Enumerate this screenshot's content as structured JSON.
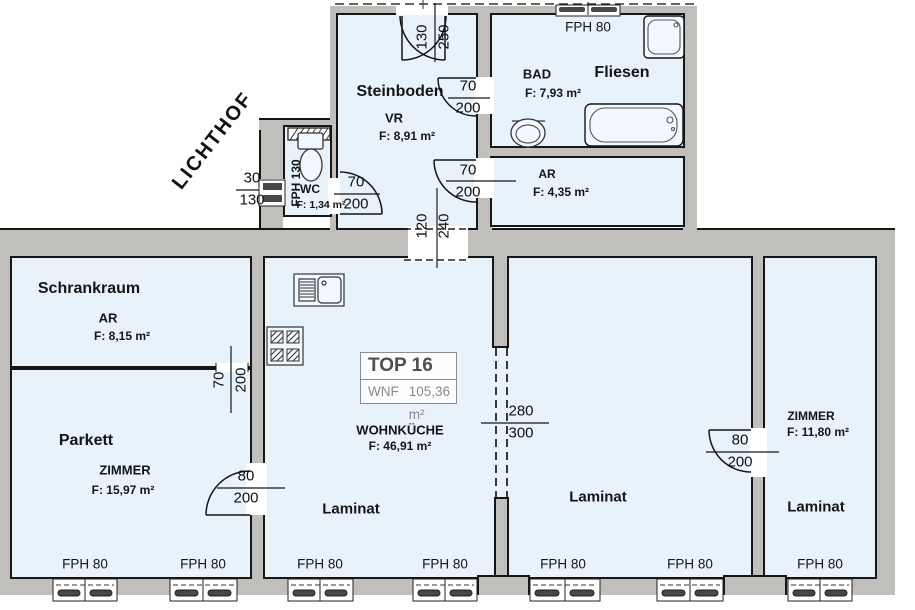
{
  "unit_box": {
    "title": "TOP 16",
    "wnf_label": "WNF",
    "wnf_value": "105,36 m²"
  },
  "labels": {
    "lichthof": "LICHTHOF",
    "steinboden": "Steinboden",
    "vr_name": "VR",
    "vr_area": "F: 8,91 m²",
    "bad_name": "BAD",
    "bad_area": "F: 7,93 m²",
    "bad_floor": "Fliesen",
    "ar_top_name": "AR",
    "ar_top_area": "F: 4,35 m²",
    "wc_name": "WC",
    "wc_area": "F: 1,34 m²",
    "wc_window": "FPH 130",
    "schrankraum": "Schrankraum",
    "schrank_type": "AR",
    "schrank_area": "F: 8,15 m²",
    "parkett_floor": "Parkett",
    "parkett_type": "ZIMMER",
    "parkett_area": "F: 15,97 m²",
    "kitchen_name": "WOHNKÜCHE",
    "kitchen_area": "F: 46,91 m²",
    "kitchen_floor": "Laminat",
    "mid_floor": "Laminat",
    "right_type": "ZIMMER",
    "right_area": "F: 11,80 m²",
    "right_floor": "Laminat",
    "fph80": "FPH 80"
  },
  "dimensions": {
    "wc_window": {
      "w": "30",
      "h": "130"
    },
    "wc_door": {
      "w": "70",
      "h": "200"
    },
    "entrance": {
      "w": "130",
      "h": "250"
    },
    "bad_door": {
      "w": "70",
      "h": "200"
    },
    "ar_door": {
      "w": "70",
      "h": "200"
    },
    "passage": {
      "w": "120",
      "h": "240"
    },
    "schrank_door": {
      "w": "70",
      "h": "200"
    },
    "parkett_door": {
      "w": "80",
      "h": "200"
    },
    "mid_opening": {
      "w": "280",
      "h": "300"
    },
    "right_door": {
      "w": "80",
      "h": "200"
    }
  },
  "icons": [
    "toilet-icon",
    "bathtub-icon",
    "shower-icon",
    "washbasin-icon",
    "kitchen-sink-icon",
    "stove-icon"
  ],
  "colors": {
    "room_fill": "#e8f2fa",
    "wall": "#c0bfbb",
    "line": "#161616",
    "window_bar": "#474747"
  }
}
